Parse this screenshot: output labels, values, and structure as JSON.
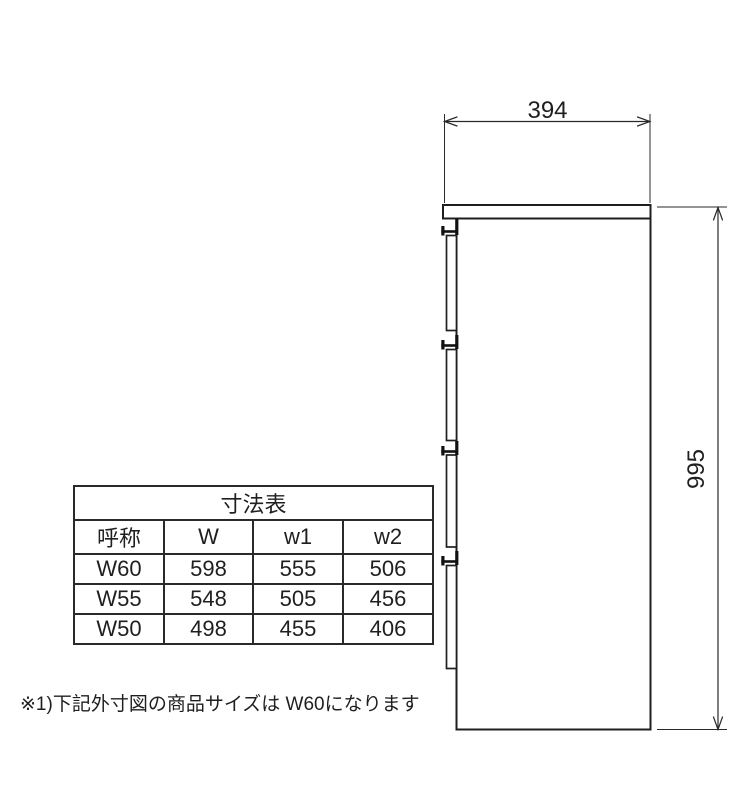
{
  "colors": {
    "line": "#1f1f1f",
    "background": "#ffffff"
  },
  "drawing": {
    "description": "side-view-of-four-drawer-chest",
    "width_dimension": "394",
    "height_dimension": "995"
  },
  "table": {
    "title": "寸法表",
    "headers": [
      "呼称",
      "W",
      "w1",
      "w2"
    ],
    "rows": [
      [
        "W60",
        "598",
        "555",
        "506"
      ],
      [
        "W55",
        "548",
        "505",
        "456"
      ],
      [
        "W50",
        "498",
        "455",
        "406"
      ]
    ]
  },
  "footnote": "※1)下記外寸図の商品サイズは W60になります"
}
